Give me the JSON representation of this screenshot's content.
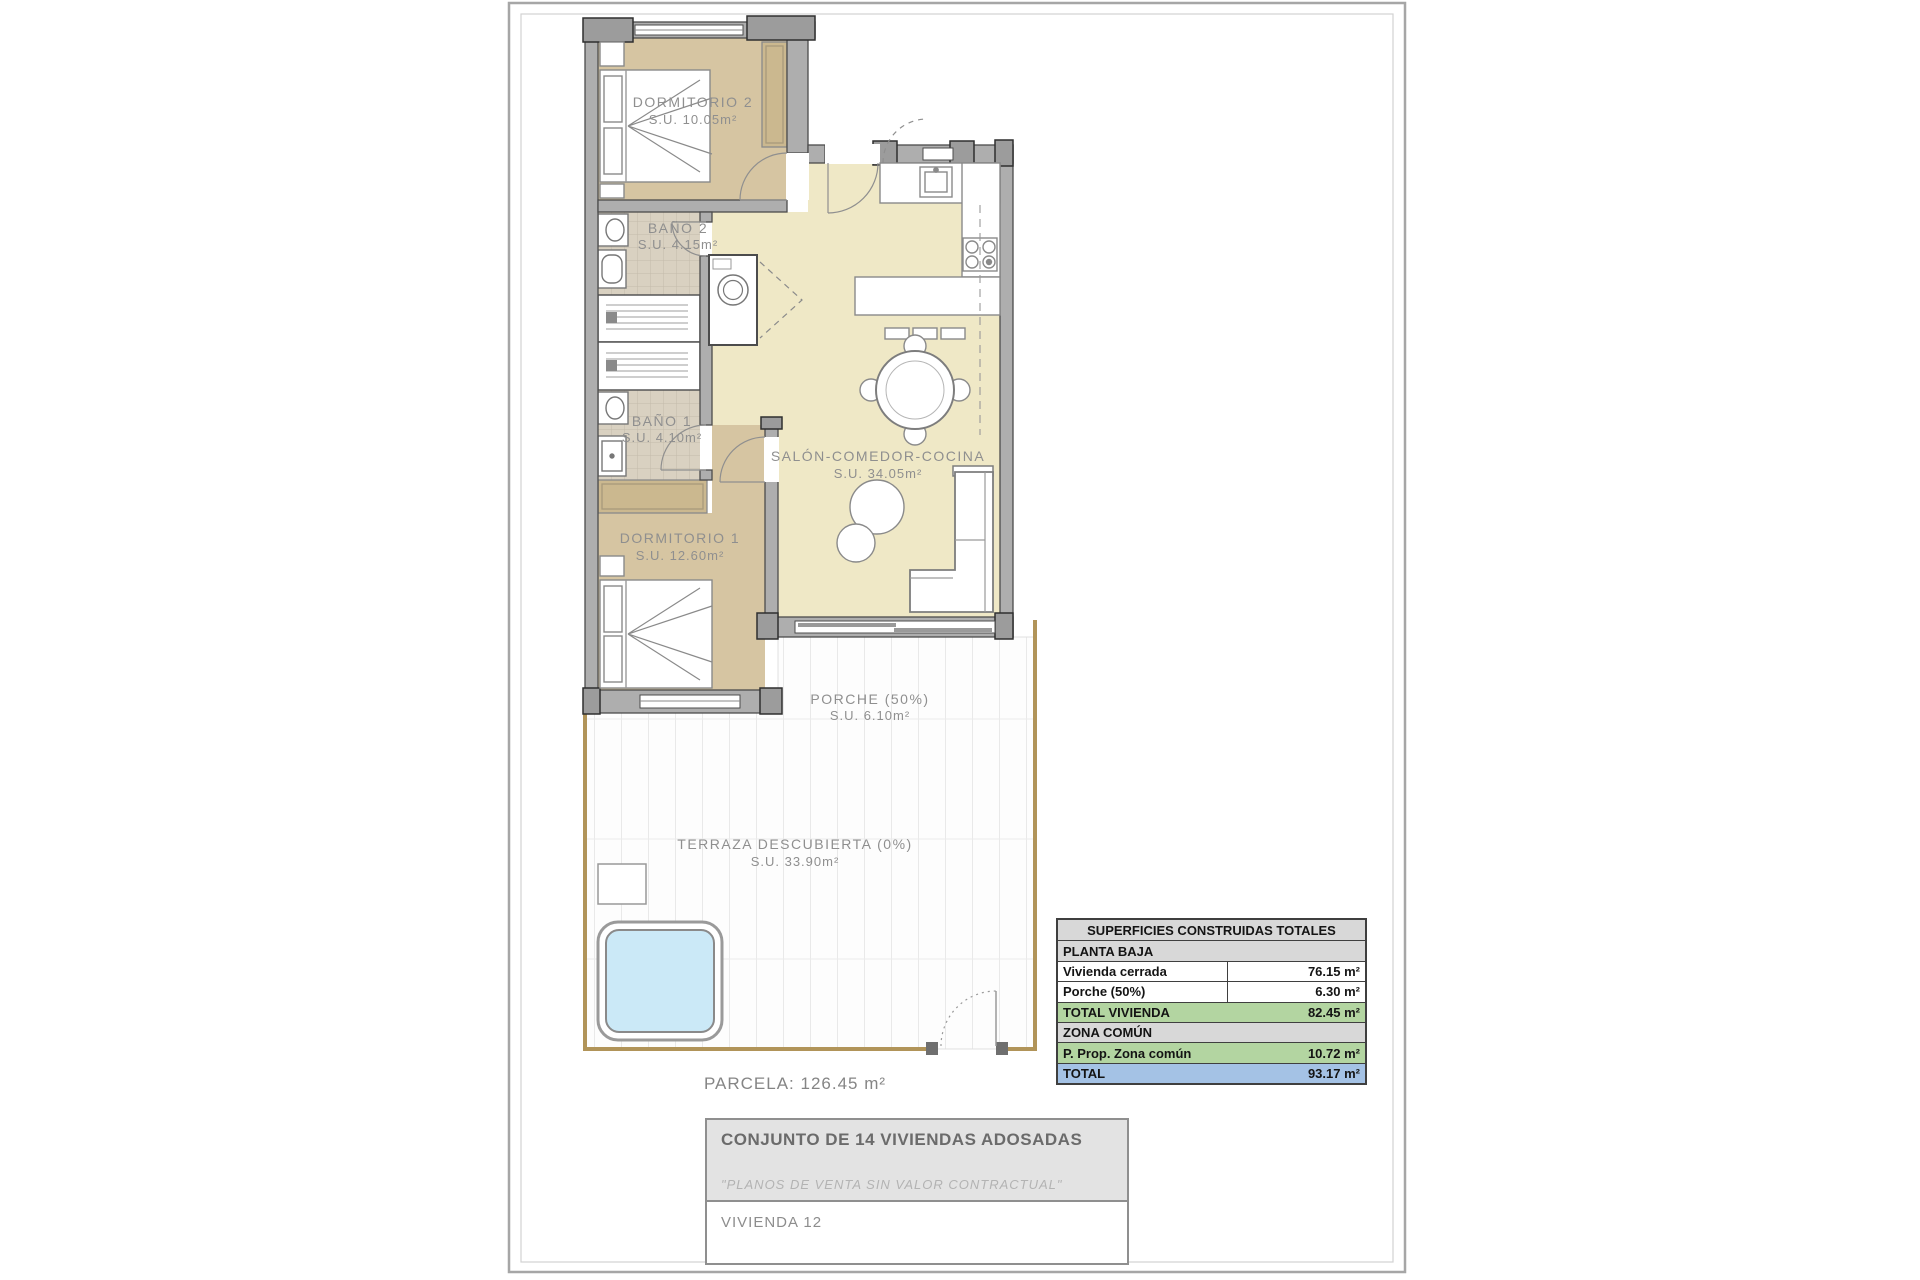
{
  "plan": {
    "parcela_label": "PARCELA: 126.45 m²",
    "rooms": [
      {
        "name": "DORMITORIO 2",
        "area": "S.U. 10.05m²"
      },
      {
        "name": "BAÑO 2",
        "area": "S.U. 4.15m²"
      },
      {
        "name": "BAÑO 1",
        "area": "S.U. 4.10m²"
      },
      {
        "name": "DORMITORIO 1",
        "area": "S.U. 12.60m²"
      },
      {
        "name": "SALÓN-COMEDOR-COCINA",
        "area": "S.U. 34.05m²"
      },
      {
        "name": "PORCHE (50%)",
        "area": "S.U. 6.10m²"
      },
      {
        "name": "TERRAZA DESCUBIERTA (0%)",
        "area": "S.U. 33.90m²"
      }
    ],
    "colors": {
      "bedroom_fill": "#d6c5a2",
      "living_fill": "#efe8c6",
      "tile_fill": "#d9d1c1",
      "wall_fill": "#aeaeae",
      "pool_fill": "#cbe9f7",
      "plot_line": "#b19459"
    }
  },
  "areas_table": {
    "rows": [
      {
        "label": "SUPERFICIES CONSTRUIDAS TOTALES",
        "value": ""
      },
      {
        "label": "PLANTA BAJA",
        "value": ""
      },
      {
        "label": "Vivienda cerrada",
        "value": "76.15 m²"
      },
      {
        "label": "Porche (50%)",
        "value": "6.30 m²"
      },
      {
        "label": "TOTAL VIVIENDA",
        "value": "82.45 m²"
      },
      {
        "label": "ZONA COMÚN",
        "value": ""
      },
      {
        "label": "P. Prop. Zona común",
        "value": "10.72 m²"
      },
      {
        "label": "TOTAL",
        "value": "93.17 m²"
      }
    ],
    "colors": {
      "header_bg": "#d8d8d8",
      "total_green": "#b3d5a1",
      "total_blue": "#a4c2e5"
    }
  },
  "title_block": {
    "project": "CONJUNTO DE 14 VIVIENDAS ADOSADAS",
    "disclaimer": "\"PLANOS DE VENTA SIN VALOR CONTRACTUAL\"",
    "unit": "VIVIENDA 12"
  }
}
